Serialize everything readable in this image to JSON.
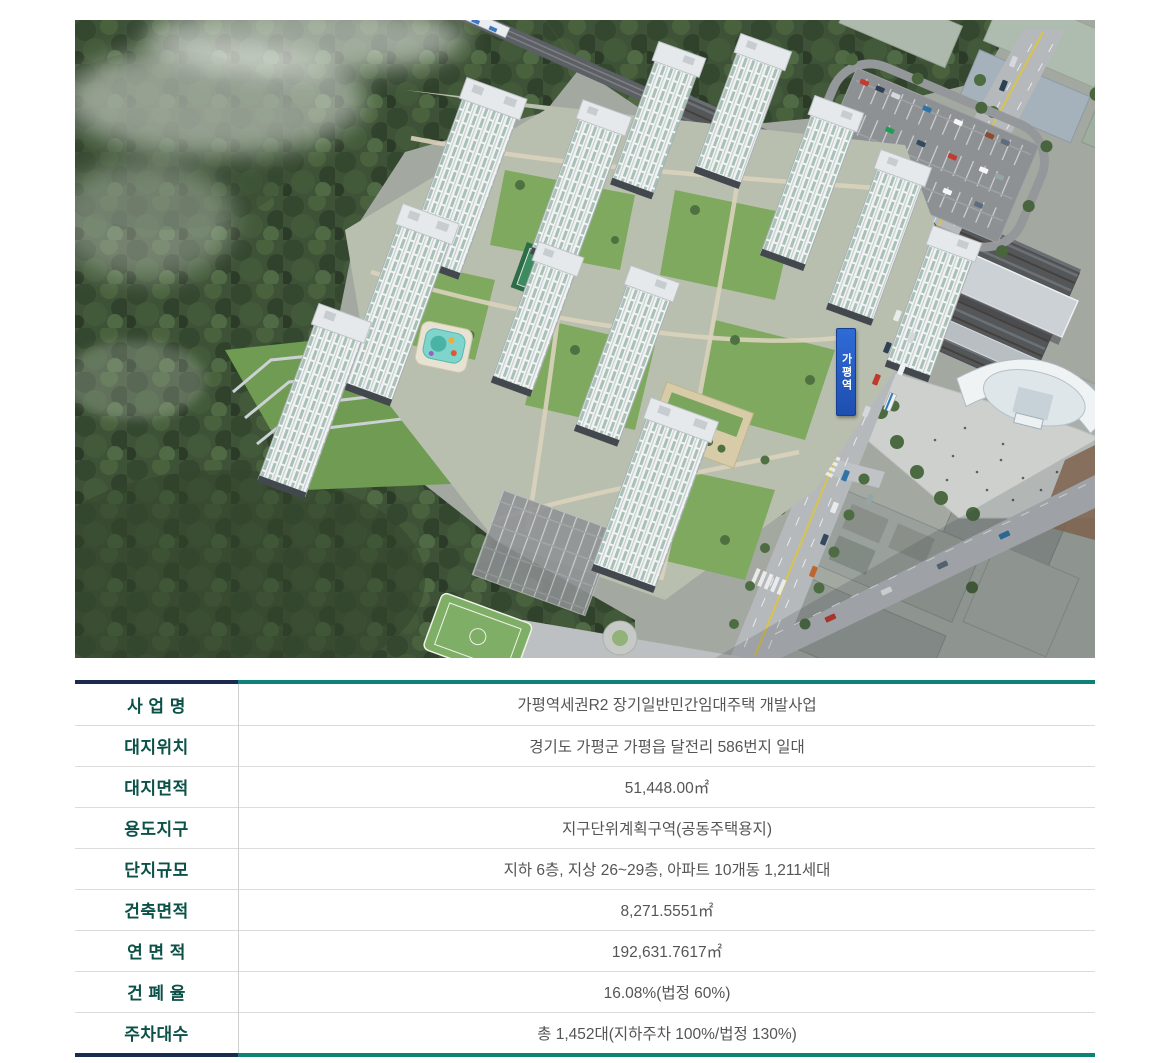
{
  "aerial": {
    "station_sign": "가평역"
  },
  "table": {
    "rows": [
      {
        "label": "사 업 명",
        "value": "가평역세권R2 장기일반민간임대주택 개발사업"
      },
      {
        "label": "대지위치",
        "value": "경기도 가평군 가평읍 달전리 586번지 일대"
      },
      {
        "label": "대지면적",
        "value": "51,448.00㎡"
      },
      {
        "label": "용도지구",
        "value": "지구단위계획구역(공동주택용지)"
      },
      {
        "label": "단지규모",
        "value": "지하 6층, 지상 26~29층, 아파트 10개동 1,211세대"
      },
      {
        "label": "건축면적",
        "value": "8,271.5551㎡"
      },
      {
        "label": "연 면 적",
        "value": "192,631.7617㎡"
      },
      {
        "label": "건 폐 율",
        "value": "16.08%(법정 60%)"
      },
      {
        "label": "주차대수",
        "value": "총 1,452대(지하주차 100%/법정 130%)"
      }
    ]
  },
  "colors": {
    "header_navy": "#1b2b4f",
    "header_teal": "#0f8278",
    "label_text": "#0b5148",
    "value_text": "#555555",
    "row_divider": "#dcdcdc",
    "station_sign_blue": "#2257c4"
  }
}
